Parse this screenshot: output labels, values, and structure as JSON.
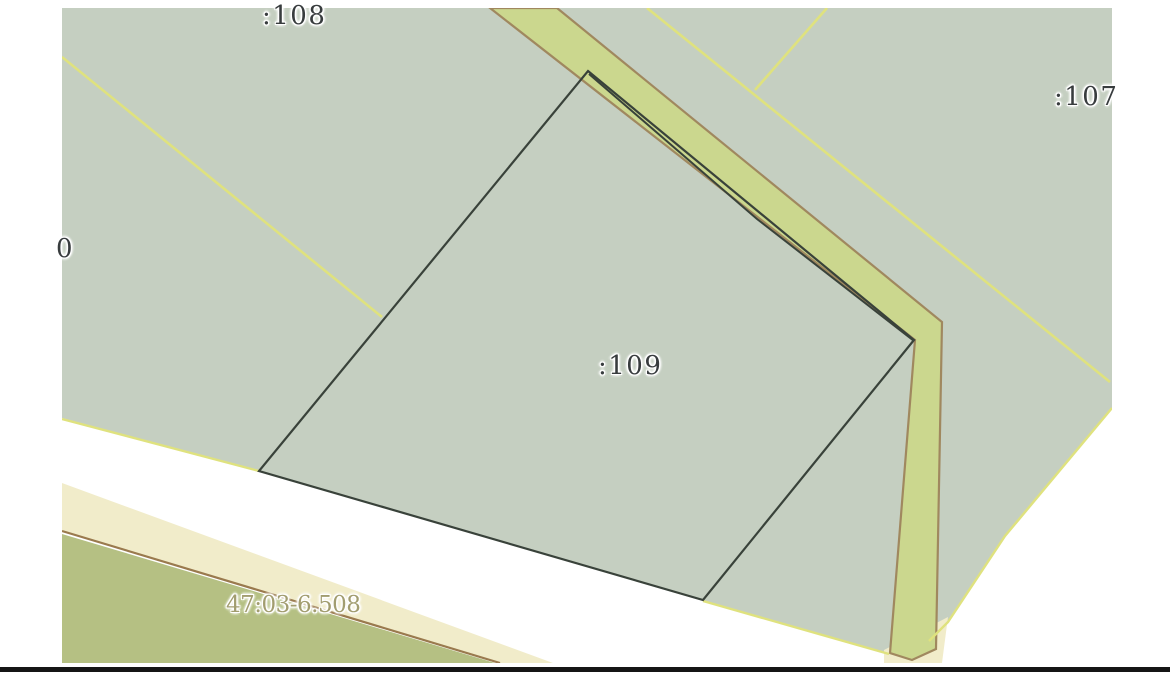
{
  "map": {
    "labels": {
      "parcel_108": ":108",
      "parcel_107": ":107",
      "parcel_109": ":109",
      "parcel_partial_left": "0",
      "zone": "47:03-6.508"
    },
    "colors": {
      "page_background": "#ffffff",
      "parcel_fill": "#c5cfc1",
      "strip_fill": "#cbd78e",
      "strip_border": "#a0885f",
      "selected_boundary": "#39423a",
      "boundary_yellow": "#dfe27e",
      "zone_cream": "#f1ecca",
      "zone_olive": "#b5c083",
      "zone_line_brown": "#9a7a4e",
      "parcel_label": "#383c3e",
      "zone_label": "#a29d6f",
      "bottom_bar": "#151515"
    }
  }
}
